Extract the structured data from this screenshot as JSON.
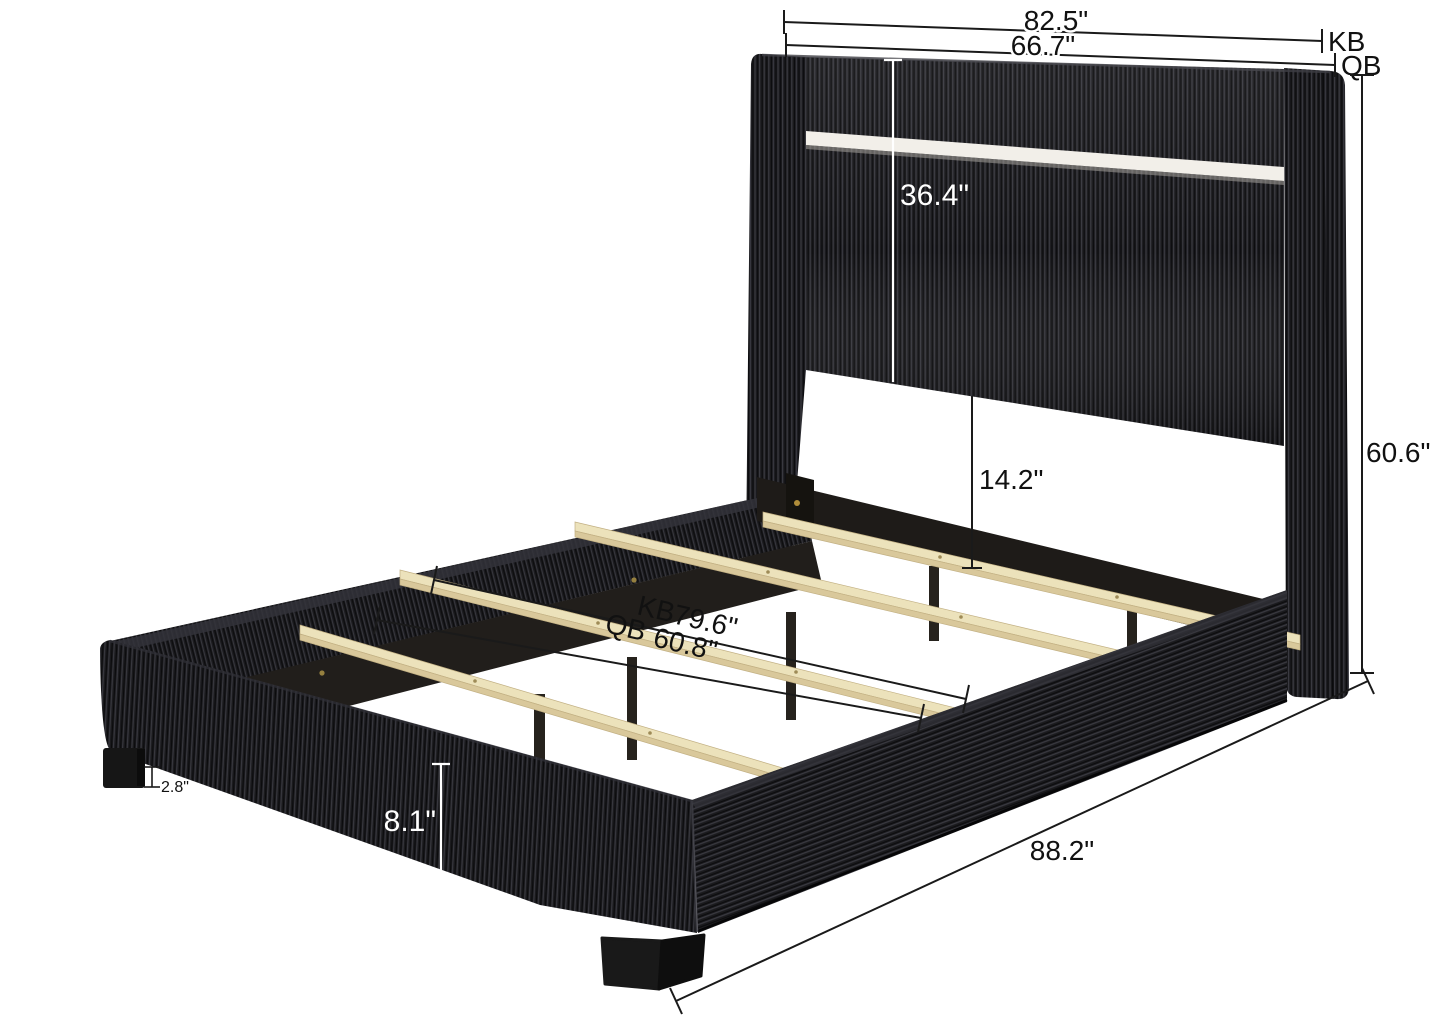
{
  "page": {
    "background": "#ffffff",
    "title": "bed-dimensions-diagram"
  },
  "product": {
    "type": "upholstered-platform-bed-with-led-headboard",
    "fabric_color": "#1b1b1e",
    "fabric_ridge_color": "#3a3a41",
    "slat_wood_color": "#ece2bb",
    "inner_rail_color": "#211e1b",
    "led_strip_color": "#f2efe9",
    "bracket_screw_color": "#b08d3a",
    "dimension_line_color": "#1a1a1a",
    "light_annotation_color": "#ffffff"
  },
  "annotations": {
    "headboard_width_king": "82.5\"",
    "headboard_width_king_size": "KB",
    "headboard_width_queen": "66.7\"",
    "headboard_width_queen_size": "QB",
    "headboard_panel_height": "36.4\"",
    "overall_height": "60.6\"",
    "headboard_to_slat_height": "14.2\"",
    "slat_width_king_size": "KB",
    "slat_width_king": "79.6\"",
    "slat_width_queen_size": "QB",
    "slat_width_queen": "60.8\"",
    "overall_length": "88.2\"",
    "foot_height": "2.8\"",
    "rail_height": "8.1\""
  }
}
